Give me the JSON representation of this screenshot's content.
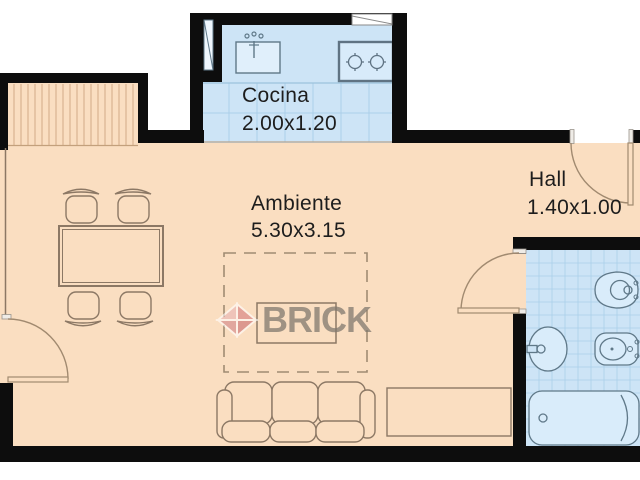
{
  "plan": {
    "rooms": {
      "kitchen": {
        "name": "Cocina",
        "dimensions": "2.00x1.20"
      },
      "living": {
        "name": "Ambiente",
        "dimensions": "5.30x3.15"
      },
      "hall": {
        "name": "Hall",
        "dimensions": "1.40x1.00"
      }
    },
    "watermark": {
      "brand": "BRICK"
    },
    "colors": {
      "wall": "#0d0d0d",
      "floor": "#fadec1",
      "wet_floor": "#cde4f6",
      "tile_line": "#abcfe9",
      "fixture_outline": "#5f7888",
      "furniture_outline": "#8c7865",
      "door_line": "#a18a70",
      "logo_red": "#d5797d",
      "logo_text_gray": "#827a6e",
      "label_text": "#1d1d1d"
    }
  }
}
